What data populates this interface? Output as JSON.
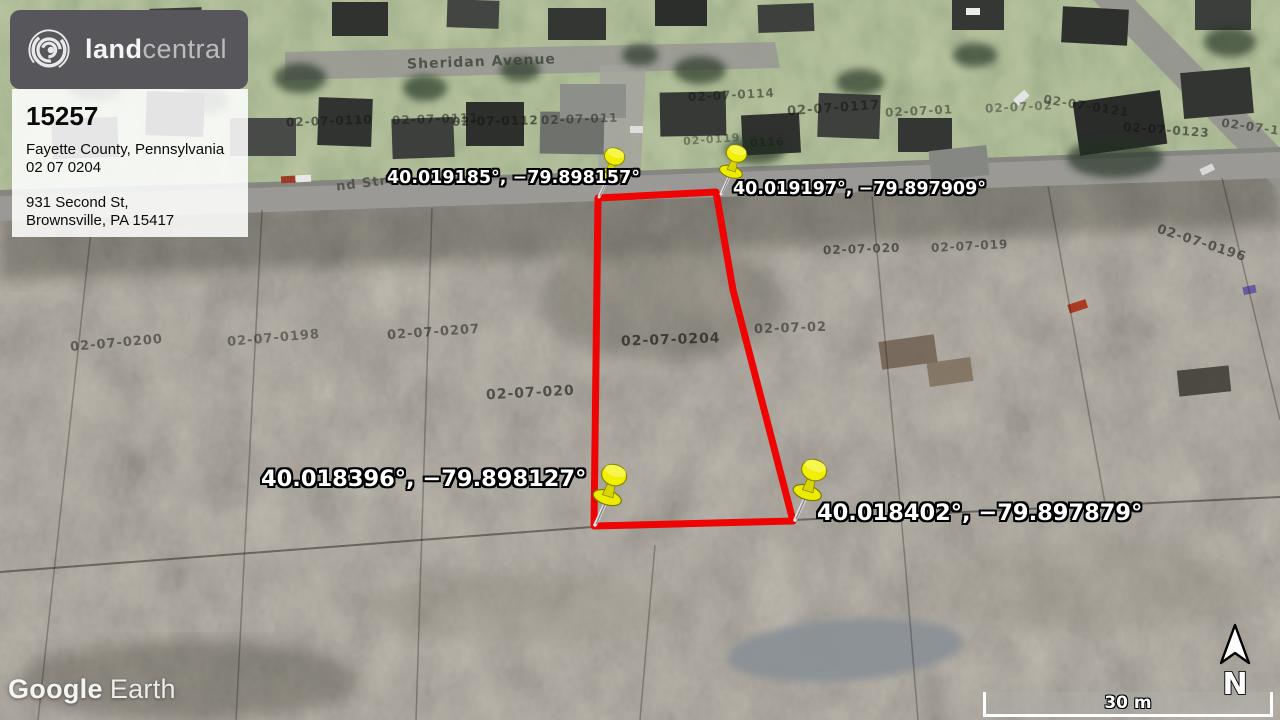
{
  "branding": {
    "logo_bold": "land",
    "logo_light": "central"
  },
  "listing_card": {
    "id": "15257",
    "county": "Fayette County, Pennsylvania",
    "apn": "02 07 0204",
    "address_line1": "931 Second St,",
    "address_line2": "Brownsville, PA 15417"
  },
  "pin_labels": {
    "nw": "40.019185°, −79.898157°",
    "ne": "40.019197°, −79.897909°",
    "sw": "40.018396°, −79.898127°",
    "se": "40.018402°, −79.897879°"
  },
  "street_labels": {
    "sheridan": "Sheridan Avenue",
    "second_partial": "nd Stre"
  },
  "parcel_overlays": [
    {
      "text": "02-07-0110"
    },
    {
      "text": "02-07-0111"
    },
    {
      "text": "02-07-0112"
    },
    {
      "text": "02-07-011"
    },
    {
      "text": "02-07-0114"
    },
    {
      "text": "02-07-0117"
    },
    {
      "text": "02-07-01"
    },
    {
      "text": "02-07-02"
    },
    {
      "text": "02-07-0121"
    },
    {
      "text": "02-07-0123"
    },
    {
      "text": "02-07-122"
    },
    {
      "text": "0116"
    },
    {
      "text": "02-0119"
    },
    {
      "text": "02-07-0200"
    },
    {
      "text": "02-07-0198"
    },
    {
      "text": "02-07-0207"
    },
    {
      "text": "02-07-020"
    },
    {
      "text": "02-07-0204"
    },
    {
      "text": "02-07-02"
    },
    {
      "text": "02-07-020"
    },
    {
      "text": "02-07-019"
    },
    {
      "text": "02-07-0196"
    }
  ],
  "watermark": {
    "app": "Google",
    "product": "Earth"
  },
  "map_controls": {
    "scale_label": "30 m",
    "north_label": "N"
  },
  "colors": {
    "boundary": "#ee0402",
    "pin_yellow": "#f1ef04",
    "card_dark": "#57565a"
  }
}
